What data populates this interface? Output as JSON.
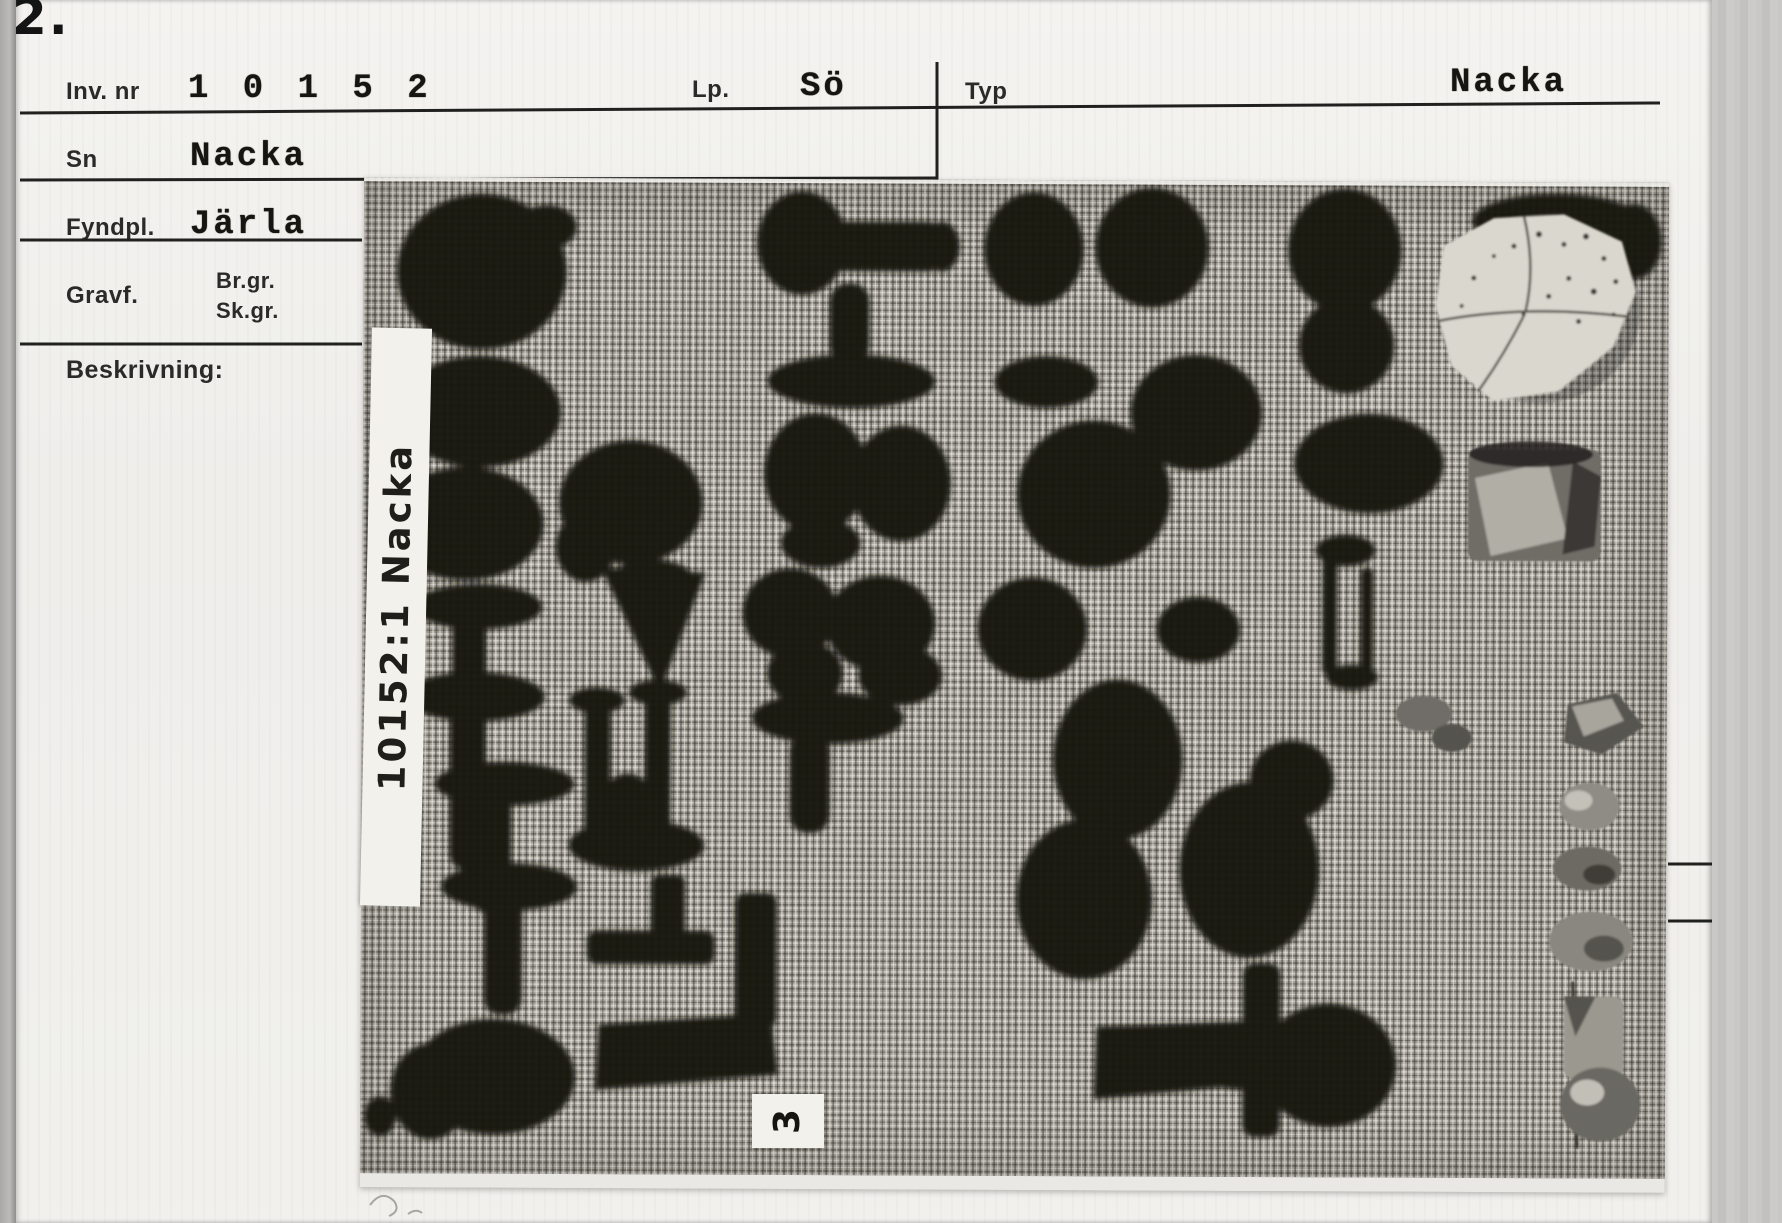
{
  "scan": {
    "corner_mark": "2."
  },
  "card": {
    "fields": {
      "inv_nr": {
        "label": "Inv. nr",
        "value": "1 0 1 5 2"
      },
      "lp": {
        "label": "Lp.",
        "value": "Sö"
      },
      "typ": {
        "label": "Typ",
        "value": "Nacka"
      },
      "sn": {
        "label": "Sn",
        "value": "Nacka"
      },
      "fyndpl": {
        "label": "Fyndpl.",
        "value": "Järla"
      },
      "gravf": {
        "label": "Gravf.",
        "option_1": "Br.gr.",
        "option_2": "Sk.gr."
      },
      "beskrivning": {
        "label": "Beskrivning:"
      }
    }
  },
  "photo": {
    "side_label": "10152:1 Nacka",
    "item_number_label": "3"
  },
  "colors": {
    "scan_background": "#c4c3c1",
    "card": "#f1f0ed",
    "typed_ink": "#17150f",
    "printed_ink": "#2b2a28",
    "burlap": "#a5a199",
    "artifact_iron": "#161310",
    "flint_light": "#dad7ce",
    "stone_gray": "#8d8a83"
  }
}
